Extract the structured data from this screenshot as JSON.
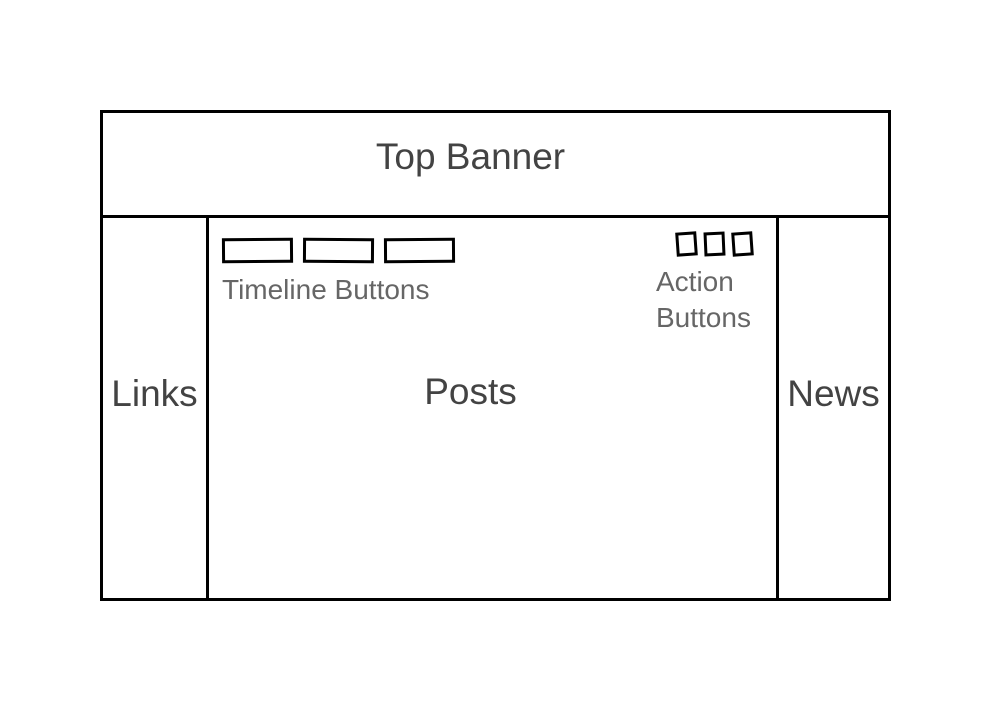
{
  "wireframe": {
    "banner": {
      "label": "Top Banner"
    },
    "left_sidebar": {
      "label": "Links"
    },
    "content": {
      "label": "Posts",
      "timeline_buttons": {
        "caption": "Timeline Buttons",
        "count": 3
      },
      "action_buttons": {
        "caption_line1": "Action",
        "caption_line2": "Buttons",
        "count": 3
      }
    },
    "right_sidebar": {
      "label": "News"
    },
    "colors": {
      "line": "#000000",
      "heading_text": "#434343",
      "caption_text": "#666666",
      "background": "#ffffff"
    }
  }
}
